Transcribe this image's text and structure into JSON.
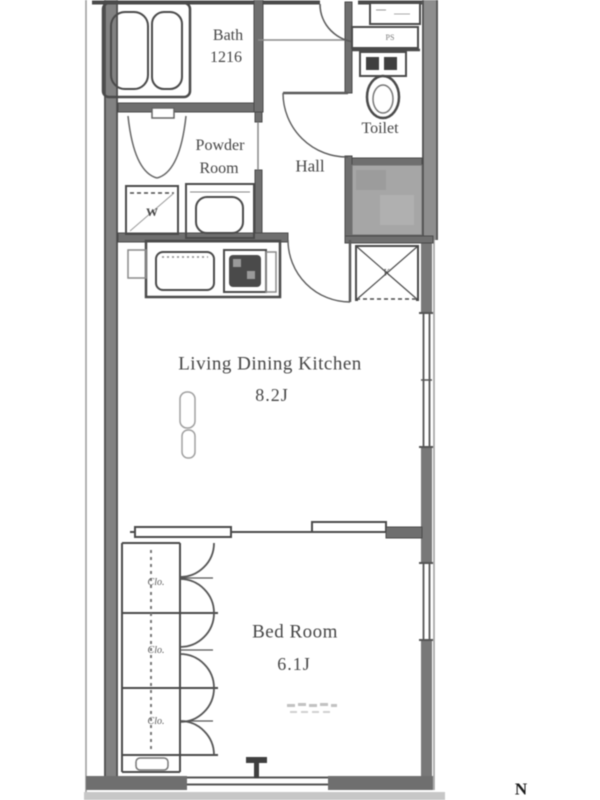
{
  "rooms": {
    "bath": {
      "name": "Bath",
      "size": "1216"
    },
    "powder_room": {
      "name_line1": "Powder",
      "name_line2": "Room"
    },
    "hall": {
      "name": "Hall"
    },
    "toilet": {
      "name": "Toilet"
    },
    "living_dining_kitchen": {
      "name": "Living Dining Kitchen",
      "size": "8.2J"
    },
    "bed_room": {
      "name": "Bed Room",
      "size": "6.1J"
    }
  },
  "labels": {
    "washing_machine": "W",
    "kitchen_box": "K",
    "pipe_space": "PS",
    "closet": "Clo.",
    "north": "N"
  },
  "colors": {
    "background": "#ffffff",
    "line": "#4a4a4a",
    "wall_fill": "#8e8e8e",
    "interior_wall_fill": "#6f6f6f",
    "shaft_fill": "#a6a6a6",
    "text": "#454545",
    "balcony_strip": "#b4b4b4"
  }
}
